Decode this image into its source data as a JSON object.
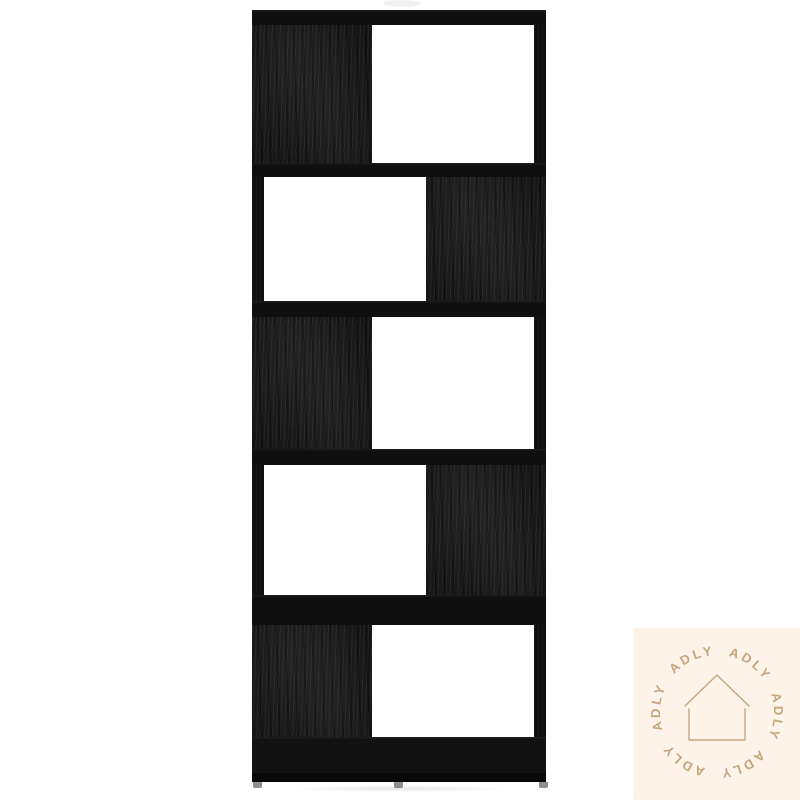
{
  "page": {
    "background_color": "#ffffff",
    "content_type": "furniture product photo"
  },
  "bookcase": {
    "description": "black wood-grain zigzag book cabinet with five open compartments",
    "tier_count": 5,
    "tiers": [
      {
        "panel_side": "left"
      },
      {
        "panel_side": "right"
      },
      {
        "panel_side": "left"
      },
      {
        "panel_side": "right"
      },
      {
        "panel_side": "left"
      }
    ],
    "wood_color": "#151515",
    "opening_color": "#ffffff",
    "feet_color": "#8f8f8f"
  },
  "watermark": {
    "label": "ADLY",
    "repeat_count": 6,
    "icon": "house-outline-icon",
    "background_color": "#fdf3e9",
    "accent_color": "#c6a67c"
  }
}
